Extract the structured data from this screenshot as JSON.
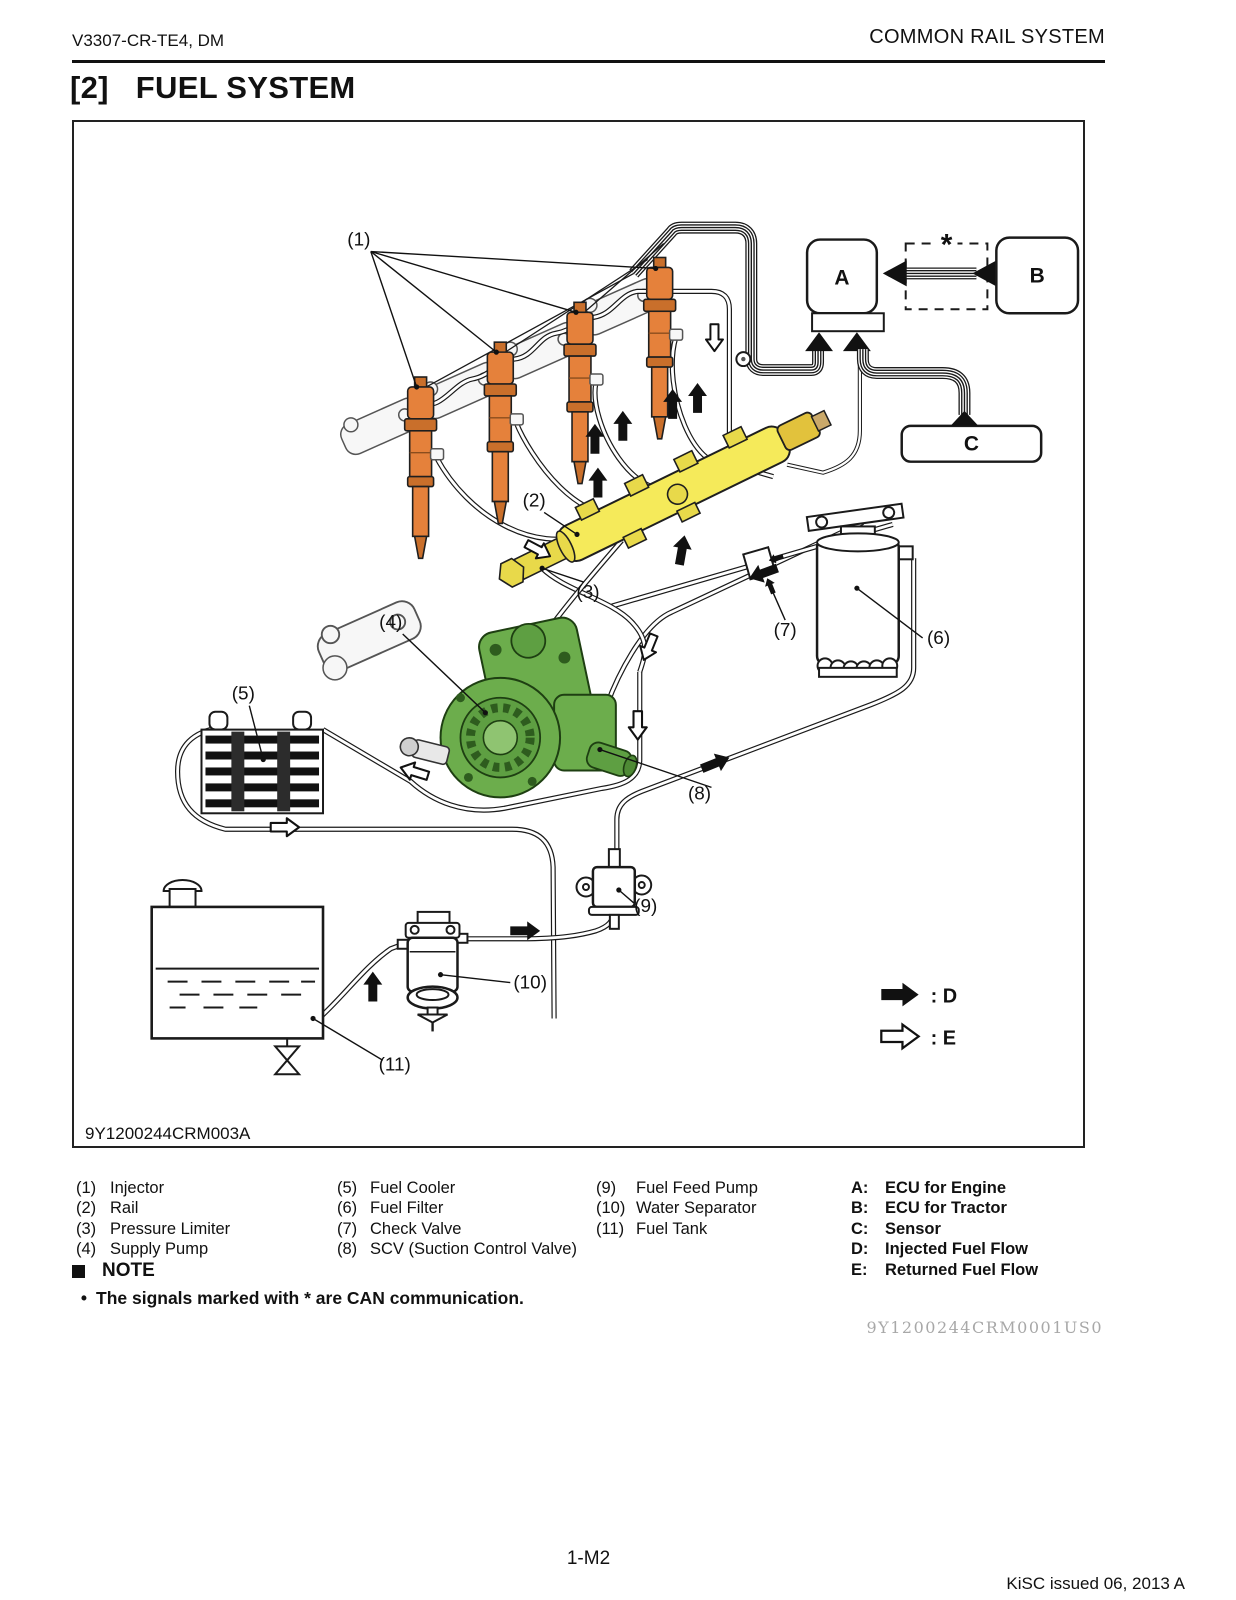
{
  "header": {
    "left": "V3307-CR-TE4, DM",
    "right": "COMMON RAIL SYSTEM"
  },
  "title": {
    "index": "[2]",
    "text": "FUEL SYSTEM"
  },
  "figure": {
    "code": "9Y1200244CRM003A",
    "callouts": {
      "c1": "(1)",
      "c2": "(2)",
      "c3": "(3)",
      "c4": "(4)",
      "c5": "(5)",
      "c6": "(6)",
      "c7": "(7)",
      "c8": "(8)",
      "c9": "(9)",
      "c10": "(10)",
      "c11": "(11)"
    },
    "boxes": {
      "a": "A",
      "b": "B",
      "c": "C"
    },
    "can_marker": "*",
    "flow": {
      "injected": ": D",
      "returned": ": E"
    },
    "colors": {
      "injector": "#E5813B",
      "rail": "#F5EA5A",
      "pump": "#6CAD4C"
    }
  },
  "legend": {
    "columns": [
      {
        "items": [
          {
            "num": "(1)",
            "label": "Injector"
          },
          {
            "num": "(2)",
            "label": "Rail"
          },
          {
            "num": "(3)",
            "label": "Pressure Limiter"
          },
          {
            "num": "(4)",
            "label": "Supply Pump"
          }
        ]
      },
      {
        "items": [
          {
            "num": "(5)",
            "label": "Fuel Cooler"
          },
          {
            "num": "(6)",
            "label": "Fuel Filter"
          },
          {
            "num": "(7)",
            "label": "Check Valve"
          },
          {
            "num": "(8)",
            "label": "SCV (Suction Control Valve)"
          }
        ]
      },
      {
        "items": [
          {
            "num": "(9)",
            "label": "Fuel Feed Pump"
          },
          {
            "num": "(10)",
            "label": "Water Separator"
          },
          {
            "num": "(11)",
            "label": "Fuel Tank"
          }
        ]
      },
      {
        "items": [
          {
            "num": "A:",
            "label": "ECU for Engine"
          },
          {
            "num": "B:",
            "label": "ECU for Tractor"
          },
          {
            "num": "C:",
            "label": "Sensor"
          },
          {
            "num": "D:",
            "label": "Injected Fuel Flow"
          },
          {
            "num": "E:",
            "label": "Returned Fuel Flow"
          }
        ]
      }
    ]
  },
  "note": {
    "heading": "NOTE",
    "bullet": "The signals marked with * are CAN communication."
  },
  "doc_code": "9Y1200244CRM0001US0",
  "footer": {
    "page": "1-M2",
    "issued": "KiSC issued 06, 2013 A"
  }
}
